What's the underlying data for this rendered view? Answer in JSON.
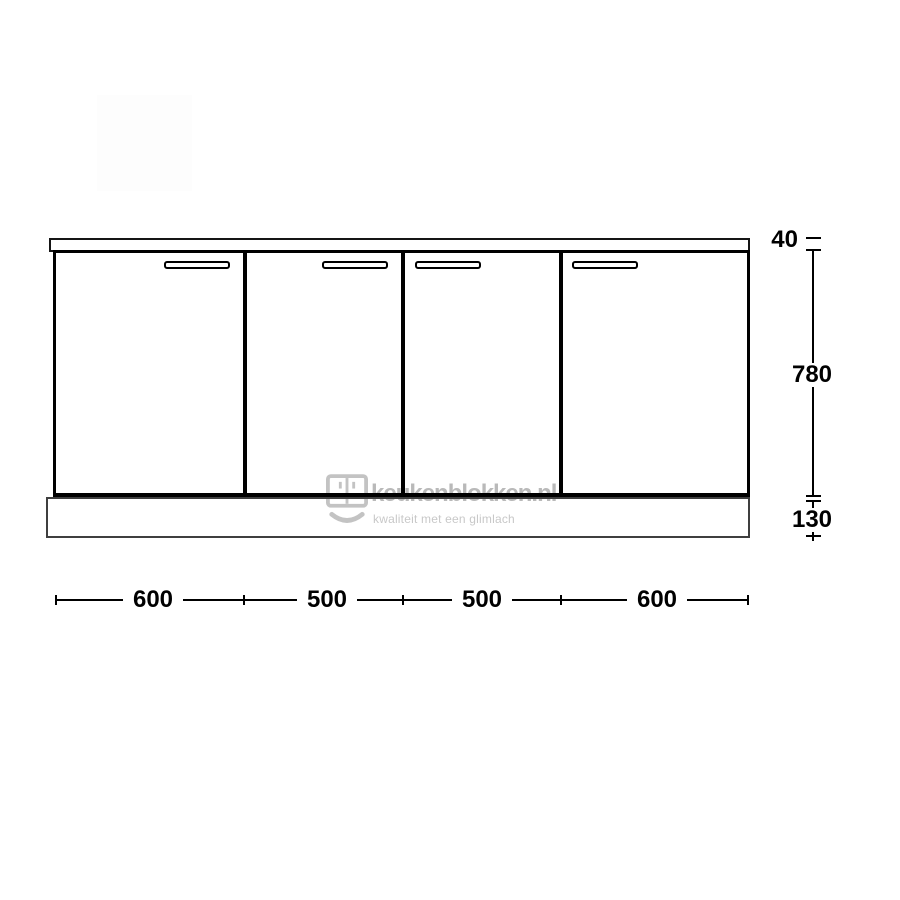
{
  "watermark": {
    "brand": "keukenblokken.nl",
    "tagline": "kwaliteit met een glimlach"
  },
  "icons": {
    "watermark_logo": "kitchen-cabinet-smile-icon"
  },
  "dimensions": {
    "vertical": [
      "40",
      "780",
      "130"
    ],
    "horizontal": [
      "600",
      "500",
      "500",
      "600"
    ]
  },
  "diagram": {
    "type": "kitchen-base-cabinet-front-elevation",
    "door_count": 4,
    "door_widths_mm": [
      600,
      500,
      500,
      600
    ],
    "countertop_height_mm": 40,
    "door_height_mm": 780,
    "plinth_height_mm": 130
  },
  "colors": {
    "line": "#000000",
    "plinth_line": "#3f3f3f",
    "watermark_text": "#b9b9b9",
    "watermark_tagline": "#c8c8c8",
    "watermark_icon": "#c3c3c3"
  }
}
